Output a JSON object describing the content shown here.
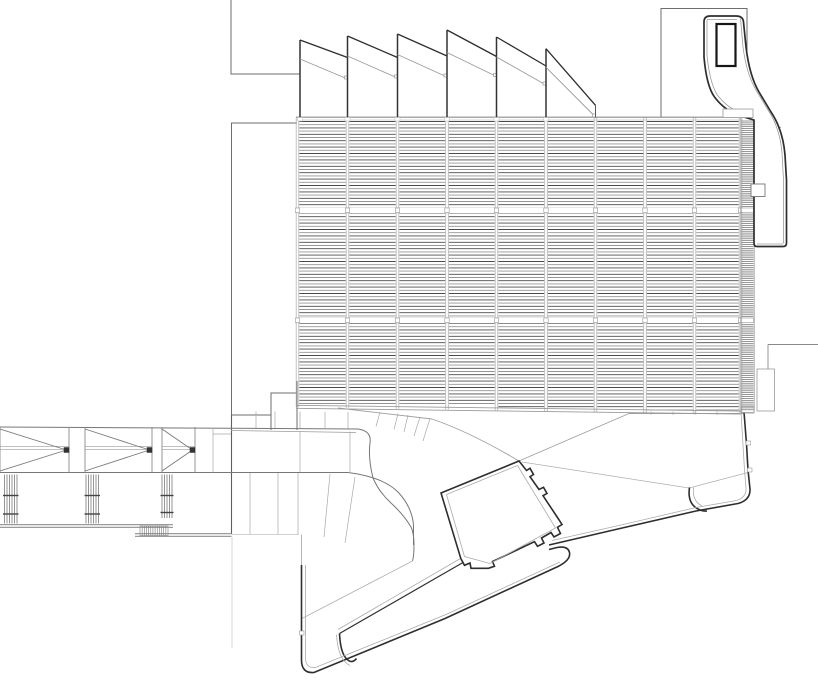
{
  "meta": {
    "background": "#ffffff",
    "canvas_width": 818,
    "canvas_height": 682,
    "drawing_type": "architectural-roof-plan"
  },
  "palette": {
    "heavy": "#2e2e2e",
    "dark": "#333333",
    "medium": "#6e6e6e",
    "mid2": "#777777",
    "light": "#9a9a9a",
    "lighter": "#ababab",
    "faint": "#c4c4c4",
    "gapline": "#cfcfcf",
    "louver_dark": "#4b4b4b",
    "louver_light": "#949494",
    "strip": "#5f5f5f",
    "gray_walk": "#9b9b9b",
    "white": "#ffffff",
    "shaft": "#161616"
  },
  "louvers": {
    "boundaries": [
      297.5,
      347.5,
      397.5,
      447,
      496.5,
      546,
      595.5,
      645,
      694.5,
      740.5
    ],
    "top": 117.5,
    "start_y": 121.5,
    "band_breaks": [
      [
        207.5,
        213.5
      ],
      [
        317.5,
        323.5
      ]
    ],
    "bottom_base": 404,
    "bottom_step": 0.85,
    "spacing": 3.2,
    "inset": 1.8,
    "line_width": 0.9,
    "mullion_color": "#b3b3b3",
    "mullion_offset": 1.3,
    "strip": {
      "x0": 741.5,
      "x1": 753.5,
      "edge0": 740.8,
      "edge1": 754.2,
      "y0": 121,
      "y1": 410,
      "spacing": 1.9,
      "width": 0.65,
      "bottom": 412.5
    }
  },
  "sawtooth": {
    "monitors": [
      {
        "x": 300,
        "apex": 40,
        "end_x": 347.5,
        "dark_end": 57.5,
        "gray_start": 59,
        "gray_end": 79
      },
      {
        "x": 347.5,
        "apex": 36,
        "end_x": 397.5,
        "dark_end": 57.5,
        "gray_start": 56,
        "gray_end": 78
      },
      {
        "x": 397.5,
        "apex": 34,
        "end_x": 447,
        "dark_end": 56,
        "gray_start": 54.5,
        "gray_end": 77
      },
      {
        "x": 447,
        "apex": 30,
        "end_x": 496.5,
        "dark_end": 56.5,
        "gray_start": 52.5,
        "gray_end": 76.5
      },
      {
        "x": 496.5,
        "apex": 37,
        "end_x": 546,
        "dark_end": 66,
        "gray_start": 57,
        "gray_end": 85
      },
      {
        "x": 546,
        "apex": 48.7,
        "end_x": 595.5,
        "dark_end": 105.3,
        "gray_start": 67.3,
        "gray_end": 117
      }
    ],
    "base_y": 118,
    "tail": "M595.5,105.3 L595.5,117.5"
  },
  "bridge": {
    "panels": [
      {
        "x0": 0,
        "x1": 69
      },
      {
        "x0": 85,
        "x1": 152
      },
      {
        "x0": 162,
        "x1": 195
      }
    ],
    "top_y": 427,
    "bot_y": 472.5,
    "chord1": 446.3,
    "chord2": 449.3,
    "node_size": 5
  },
  "posts": [
    {
      "x0": 4.5,
      "x1": 17,
      "n": 6,
      "y0": 474.5,
      "y1": 523.5,
      "ticks": [
        495.5,
        514
      ]
    },
    {
      "x0": 86,
      "x1": 98.5,
      "n": 6,
      "y0": 474.5,
      "y1": 523.5,
      "ticks": [
        495.5,
        514
      ]
    },
    {
      "x0": 162,
      "x1": 172,
      "n": 5,
      "y0": 474.5,
      "y1": 518,
      "ticks": [
        495.5,
        512.5
      ]
    }
  ],
  "stair": {
    "x": 140,
    "y": 526,
    "w": 28,
    "h": 9.5,
    "n": 13
  },
  "rects": [
    {
      "name": "strip-top-joint-box",
      "x": 723,
      "y": 109,
      "w": 30,
      "h": 8.5,
      "stroke": "#9a9a9a",
      "sw": 0.8,
      "fill": "#ffffff"
    },
    {
      "name": "right-lower-panel",
      "x": 757,
      "y": 369,
      "w": 17.5,
      "h": 42,
      "stroke": "#9a9a9a",
      "sw": 0.8,
      "fill": "none"
    },
    {
      "name": "strip-bottom-box",
      "x": 741,
      "y": 406.5,
      "w": 13,
      "h": 6,
      "stroke": "#9a9a9a",
      "sw": 0.7,
      "fill": "none"
    },
    {
      "name": "hatch-symbol-box",
      "x": 751,
      "y": 184,
      "w": 14,
      "h": 12.5,
      "stroke": "#777777",
      "sw": 0.9,
      "fill": "#ffffff"
    },
    {
      "name": "edge-joint-tick-1",
      "x": 746,
      "y": 441,
      "w": 4.5,
      "h": 4,
      "stroke": "#9a9a9a",
      "sw": 0.6,
      "fill": "#ffffff"
    },
    {
      "name": "edge-joint-tick-2",
      "x": 747.5,
      "y": 468,
      "w": 4.5,
      "h": 4,
      "stroke": "#9a9a9a",
      "sw": 0.6,
      "fill": "#ffffff"
    },
    {
      "name": "edge-joint-tick-3",
      "x": 299.5,
      "y": 631,
      "w": 4.5,
      "h": 4,
      "stroke": "#9a9a9a",
      "sw": 0.6,
      "fill": "#ffffff"
    }
  ],
  "layers": [
    {
      "name": "top-left-outline",
      "stroke": "#6e6e6e",
      "width": 1,
      "segs": [
        "M231,0 L231,74 L300,74",
        "M297,123 L231.5,123 L231.5,415 L271,415",
        "M271,430 L271,393 L297,393 L297,430",
        "M297,381 L297,393",
        {
          "d": "M231.5,415 L231.5,534",
          "stroke": "#5f5f5f",
          "w": 1.1
        },
        "M661,117 L661,8.5 L747,8.5 L747,117"
      ]
    },
    {
      "name": "walkway-band",
      "stroke": "#777777",
      "width": 1,
      "segs": [
        "M0,427 L358,429 Q372,431 370,443 Q368,458 373,478 Q379,492 391,503 Q404,515 411,527 Q414,533 414,545 Q414,556 412.5,561",
        {
          "d": "M231,430.5 L356,432.5",
          "stroke": "#9a9a9a",
          "w": 0.8
        },
        "M0,472.5 L348,472.5 Q383,477 398,492 Q412,507 413.5,525 L413.5,545",
        {
          "d": "M300,431 L300,472 M350,431.5 L350,472 M250,473 L250,534 M278,473 L278,534 M298,473 L298,534 M330,474 L324,537 M355,477 L345,543",
          "stroke": "#a8a8a8",
          "w": 0.7
        },
        {
          "d": "M256,411.5 L256,428 M275,411.5 L275,428 M300,411.5 L300,428.5 M325,412 L325,429 M348,412 L348,430 M380,412 L376,426.5 M398,413.5 L394,429.5 M408,415 L404,432 M420,417 L414,436 M430,418.5 L423,441",
          "stroke": "#a8a8a8",
          "w": 0.7
        },
        {
          "d": "M213,428 L213,472.5 M213,434 L231,434",
          "stroke": "#a8a8a8",
          "w": 0.7
        },
        {
          "d": "M412.5,561 L302,618.5",
          "stroke": "#b0b0b0",
          "w": 0.8
        },
        {
          "d": "M338,408 L432,419 Q470,432 519,461",
          "stroke": "#9f9f9f",
          "w": 0.9
        },
        {
          "d": "M519,461 L629,413.5 M629,413.5 L744,413.5",
          "stroke": "#9f9f9f",
          "w": 0.9
        },
        {
          "d": "M651,411.5 L651,415 M673,411.5 L673,415 M695,411.5 L695,415 M717,411.5 L717,415",
          "stroke": "#b0b0b0",
          "w": 0.7
        },
        {
          "d": "M522,462 L689,488 M689,488 L748,472.5",
          "stroke": "#b0b0b0",
          "w": 0.8
        }
      ]
    },
    {
      "name": "walkway-gray-lines",
      "stroke": "#9b9b9b",
      "width": 1.3,
      "segs": [
        "M0,524.6 L173,524.6",
        "M0,527.4 L173,527.4",
        "M135,533.6 L231.5,533.6",
        "M135,536.4 L231.5,536.4",
        {
          "d": "M231.5,534.5 L299,534.5",
          "stroke": "#c0c0c0",
          "w": 0.7
        },
        {
          "d": "M232,537 L232,648",
          "stroke": "#c4c4c4",
          "w": 0.7
        },
        {
          "d": "M301.5,534.5 L301.5,565",
          "stroke": "#ababab",
          "w": 0.9
        }
      ]
    },
    {
      "name": "plaza-outline-heavy",
      "stroke": "#2e2e2e",
      "width": 1.6,
      "segs": [
        "M744,412 L746.5,444 L748,470 L750,489 Q750.5,500 738,503.5 L696,511 L620,528.5 L549,545",
        "M689.5,487.5 Q687,504 699,509.5 Q703,511.5 707,511",
        "M301.5,565 L301.5,660 Q301.5,673.5 314,672.5 L445,618.5 L558,566.5 Q571,560 569.5,552.5 Q568,545.5 557,547.5 L549,549.5",
        {
          "d": "M463,562.5 L339.5,633.5",
          "w": 1.2
        },
        "M339.5,633.5 Q340.5,656 349,660.8 Q353,663 356.5,658.5"
      ]
    },
    {
      "name": "plaza-outline-light",
      "stroke": "#ababab",
      "width": 0.8,
      "segs": [
        "M741,412 L744.5,470 L746,488 Q746.5,497.5 736.5,500.5 L696,507.5 L621,525 L552,540.5",
        "M305.5,565 L305.5,658 Q305.5,668.5 315.5,667.5 L446,614.5 L560,562",
        "M693.5,487.5 Q692,501 702,506",
        "M336.5,634.5 Q338,660 350,665.5",
        "M460.5,558.5 L338,629.5"
      ]
    },
    {
      "name": "courtyard-square-heavy",
      "stroke": "#2e2e2e",
      "width": 1.6,
      "segs": [
        "M441,493 L519,461 L526.5,470.5 L530,468.3 L533.5,474.5 L530,476.7 L539,489.5 L543.5,487.3 L547,493.5 L543,495.7 L557.5,517.5 L562,524.5 L557.5,527.3 L560.5,533.5 L554,537 L551,532.5 L541.5,538 L544,543 L537.5,546.3 L534.5,541.7 L492.5,561.5 L494.5,566.3 L488.5,568.3 L471,568.3 L470,563 L464.5,565.3 L460.8,558.5 Z"
      ]
    },
    {
      "name": "courtyard-square-inner",
      "stroke": "#ababab",
      "width": 0.8,
      "segs": [
        "M446.5,494.5 L517.5,465.5 L555.5,528 L490,563.5 L464.5,556.5 Z"
      ]
    },
    {
      "name": "tower-details",
      "stroke": "#8a8a8a",
      "width": 0.75,
      "segs": [
        "M755.5,131 L781,127.5",
        "M755.5,162 L783.5,152.5",
        "M755.5,184.5 L785,183",
        "M755.5,211.5 L785.5,210",
        {
          "d": "M768,344.5 L818,344.5 M768,344.5 L768,369",
          "stroke": "#8a8a8a",
          "w": 0.9
        }
      ]
    }
  ],
  "tower": {
    "outer": "M704,57 L704,22 Q704,16 710,16 L736,16 Q743,16 743.5,22 L746,47 Q749.5,76 759,92 L771,112 Q783,130 785,155 L786.5,180 L786.5,243 Q786.5,246.5 783,246.5 L757,246.5 Q754,246.5 754,243 L754,120 Q746,117.5 740.5,116 Q725,111 714.5,97 Q706.5,86 704,57 Z",
    "inner_lines": [
      "M740.5,18.5 L743,47 Q746.5,74 756,90 L768,110 Q780,128 782,153 L783.5,180 L783.5,243.5",
      "M783,244 L757,244",
      "M707,19.5 L737,19.5",
      "M707,20 L707,55 Q709.5,82 717,94.5 Q727,108 741.5,113"
    ],
    "shaft": {
      "x": 716.5,
      "y": 24,
      "w": 19,
      "h": 42
    },
    "symbol_lines": [
      "M752,195 L764,185.8",
      "M756.5,195 L764,188"
    ]
  }
}
